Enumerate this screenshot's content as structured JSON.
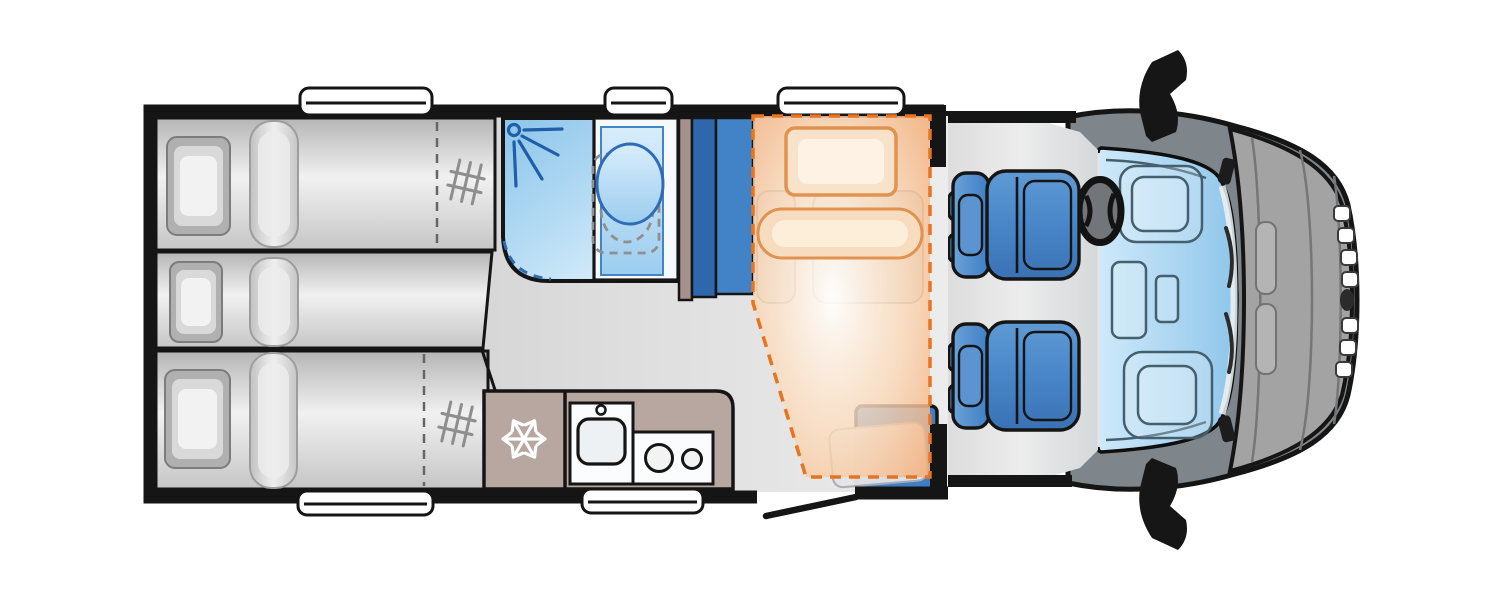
{
  "meta": {
    "type": "motorhome-floorplan",
    "view": "top-down",
    "vehicle_front": "right",
    "visible_text": "none"
  },
  "colors": {
    "wall": "#151515",
    "floor_light": "#e9e9e9",
    "shower_blue": "#9fcdec",
    "plumbing_blue": "#2f6cb5",
    "bench_blue": "#4283c8",
    "bench_blue_dark": "#2e67ac",
    "seat_blue": "#3f7ec6",
    "seat_blue_light": "#6ba3d8",
    "overlay_dash": "#e87320",
    "overlay_soft": "#e2924f",
    "kitchen_taupe": "#b8a7a1",
    "partition_taupe": "#a5928c",
    "cab_frame_gray": "#7e858b",
    "bonnet_gray": "#a3a3a3",
    "windshield_blue": "#a8d4ef",
    "mirror_black": "#161616",
    "snowflake_white": "#ffffff"
  },
  "areas": {
    "rear_bedroom": {
      "beds": [
        {
          "name": "bunk-top",
          "pillow": true,
          "duvet_roll": true,
          "ladder_icon": true,
          "dashed_extension": true
        },
        {
          "name": "bunk-middle",
          "pillow": true,
          "duvet_roll": true,
          "ladder_icon": false,
          "dashed_extension": false
        },
        {
          "name": "bunk-bottom",
          "pillow": true,
          "duvet_roll": true,
          "ladder_icon": true,
          "dashed_extension": true
        }
      ]
    },
    "washroom": {
      "features": [
        "shower-tray",
        "shower-head-icon",
        "washbasin",
        "toilet-dashed-outline"
      ]
    },
    "mid_section": {
      "features": [
        "partition-wall",
        "travel-bench-seat"
      ]
    },
    "dinette": {
      "overlay": "drop-down-bed",
      "features": [
        "overlay-pillow",
        "overlay-duvet",
        "seat-bases",
        "entrance-side-seat"
      ]
    },
    "entrance": {
      "door_state": "open"
    },
    "kitchen": {
      "appliances": [
        {
          "name": "fridge",
          "icon": "snowflake-icon"
        },
        {
          "name": "sink",
          "icon": "tap-icon"
        },
        {
          "name": "hob",
          "burners": 2
        }
      ]
    },
    "cab": {
      "seats": [
        "driver-swivel-seat",
        "passenger-swivel-seat"
      ],
      "features": [
        "steering-wheel",
        "windshield",
        "dashboard",
        "wing-mirror-top",
        "wing-mirror-bottom",
        "front-grille",
        "brand-emblem",
        "bonnet"
      ]
    },
    "windows": {
      "top_wall": 3,
      "bottom_wall": 2
    }
  }
}
